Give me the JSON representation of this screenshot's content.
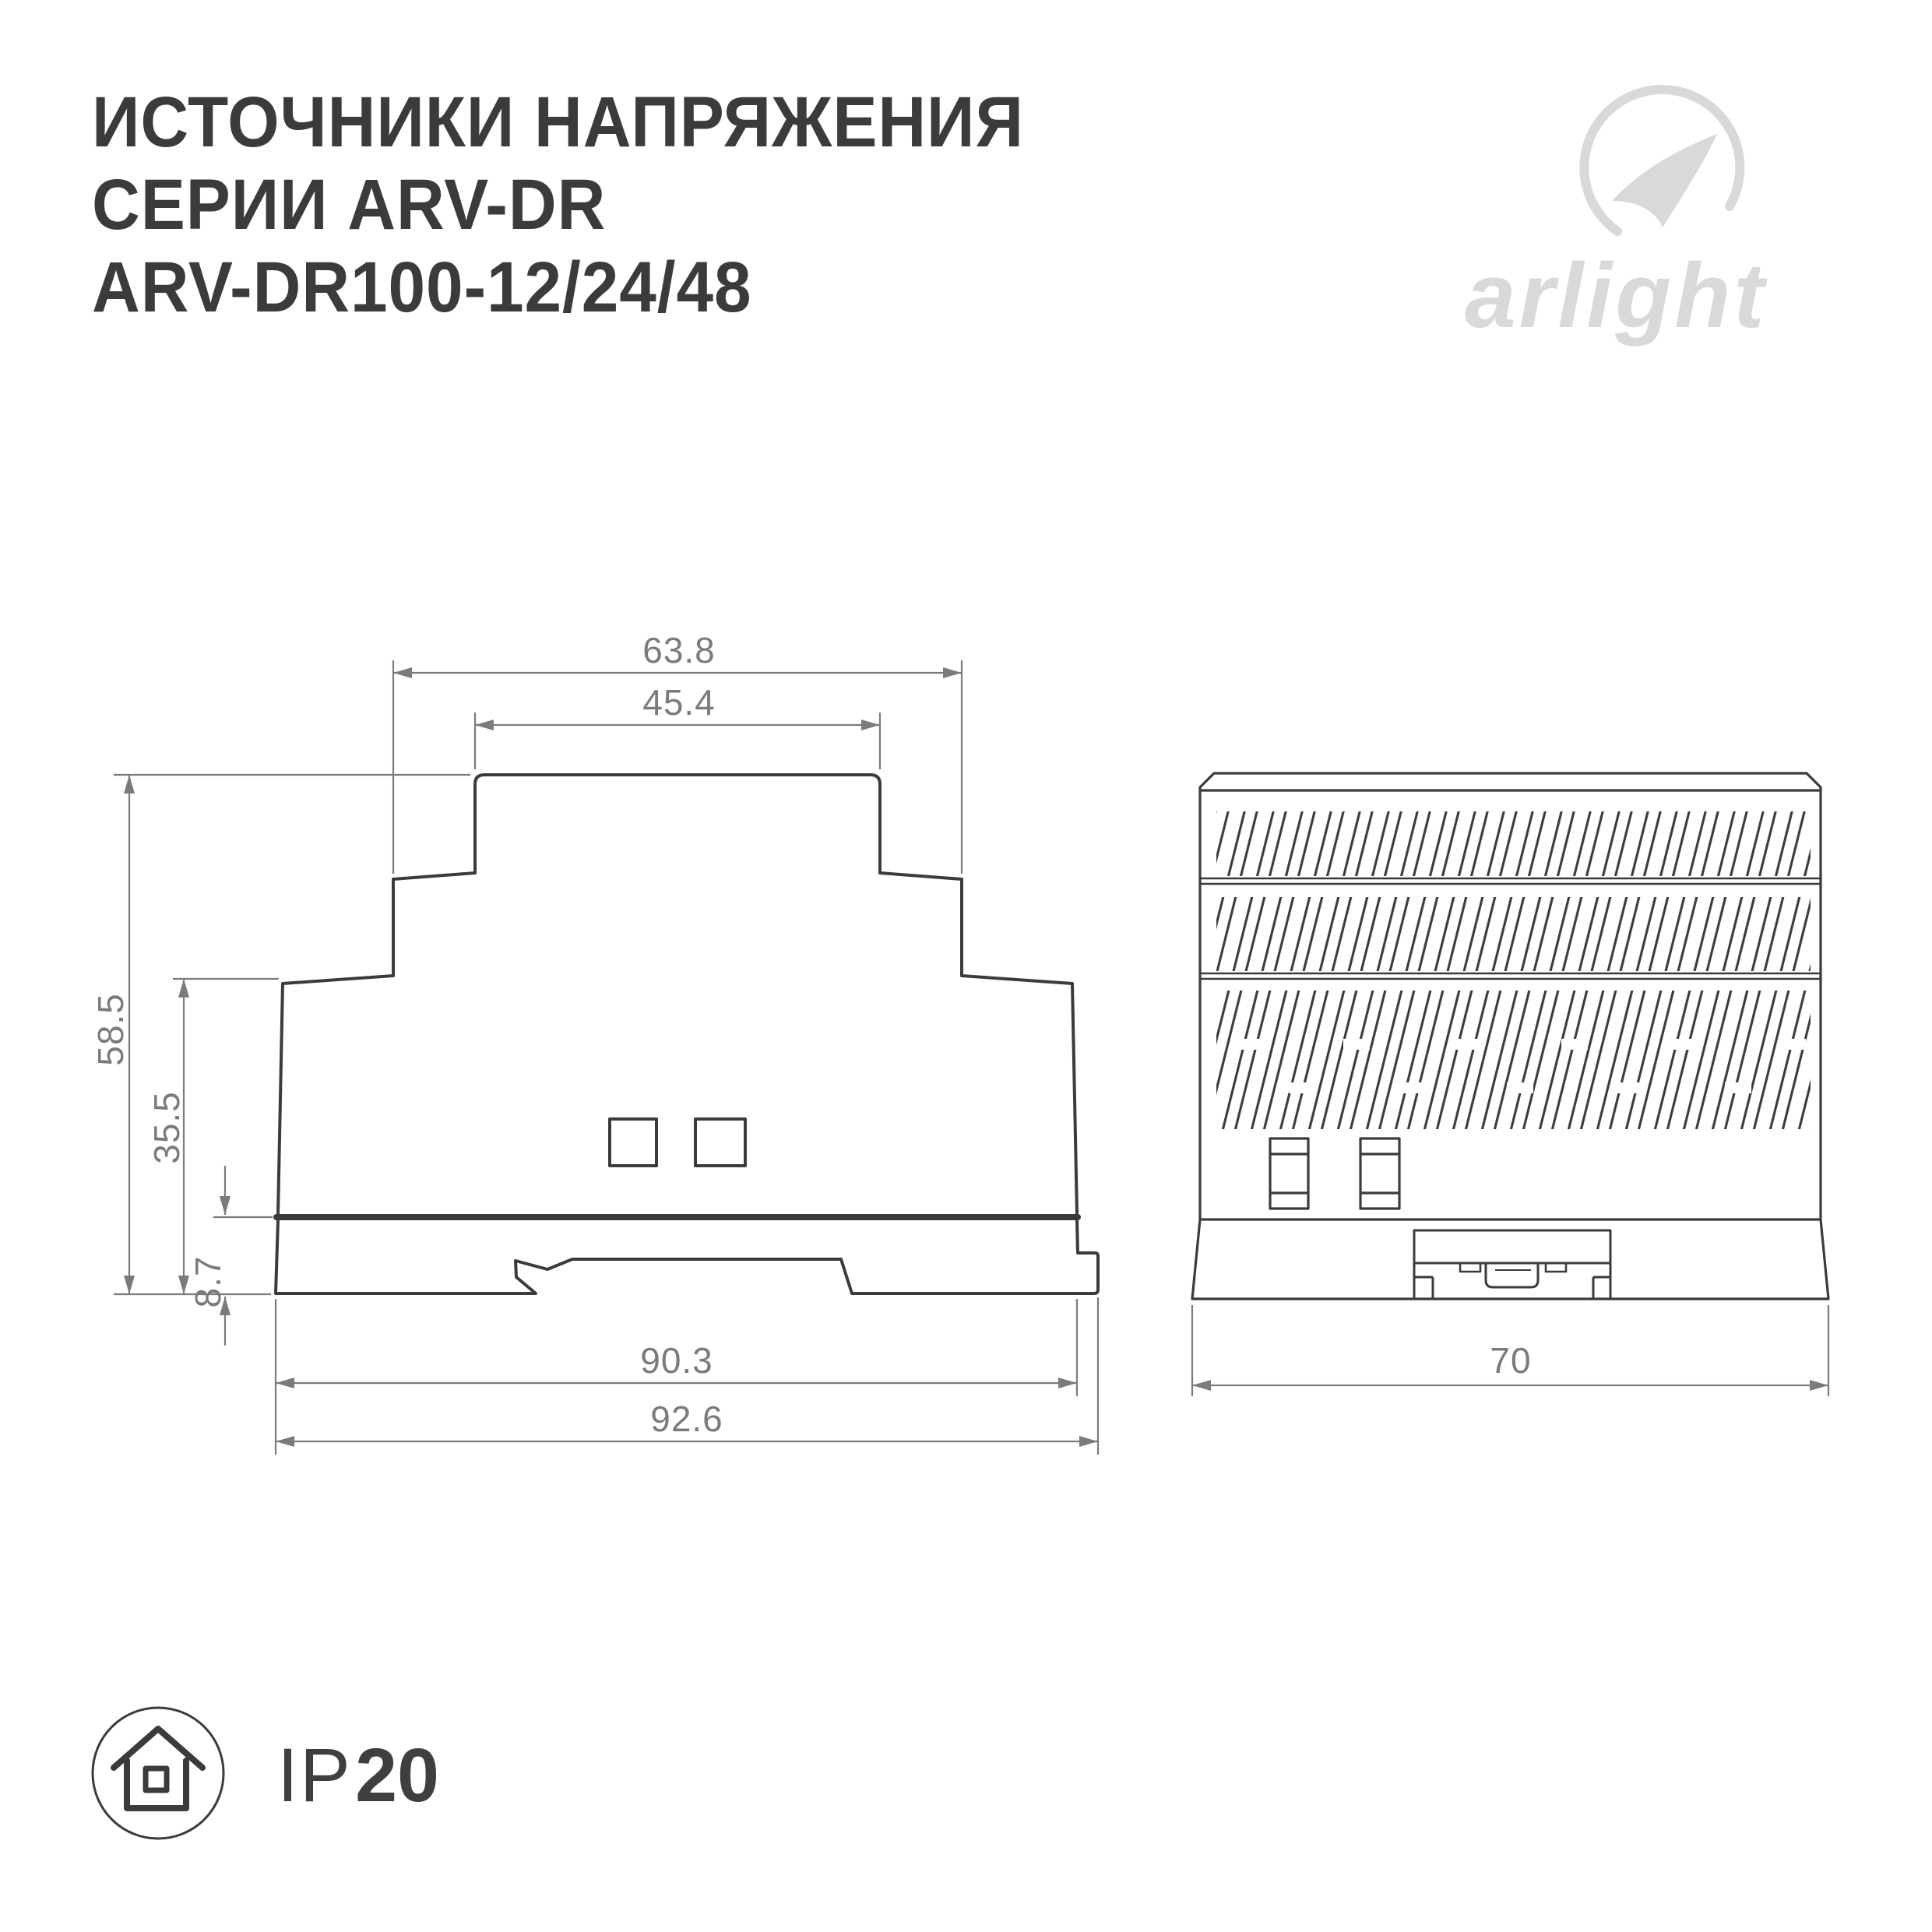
{
  "colors": {
    "background": "#ffffff",
    "line": "#3b3b3b",
    "dimension": "#7b7b7b",
    "logo_gray": "#d9d9d9",
    "title_text": "#3b3b3b"
  },
  "title": {
    "line1": "ИСТОЧНИКИ НАПРЯЖЕНИЯ",
    "line2": "СЕРИИ ARV-DR",
    "line3": "ARV-DR100-12/24/48"
  },
  "logo": {
    "wordmark": "arlight",
    "icon": "swoosh-icon"
  },
  "front_view": {
    "description": "front profile drawing with dimensions in mm",
    "dims": {
      "step_width": "63.8",
      "top_width": "45.4",
      "total_height": "58.5",
      "upper_height": "35.5",
      "base_height": "8.7",
      "body_width": "90.3",
      "overall_width": "92.6"
    }
  },
  "side_view": {
    "description": "side view with vent louvers and DIN clip",
    "dims": {
      "width": "70"
    }
  },
  "badge": {
    "prefix": "IP",
    "rating": "20"
  }
}
